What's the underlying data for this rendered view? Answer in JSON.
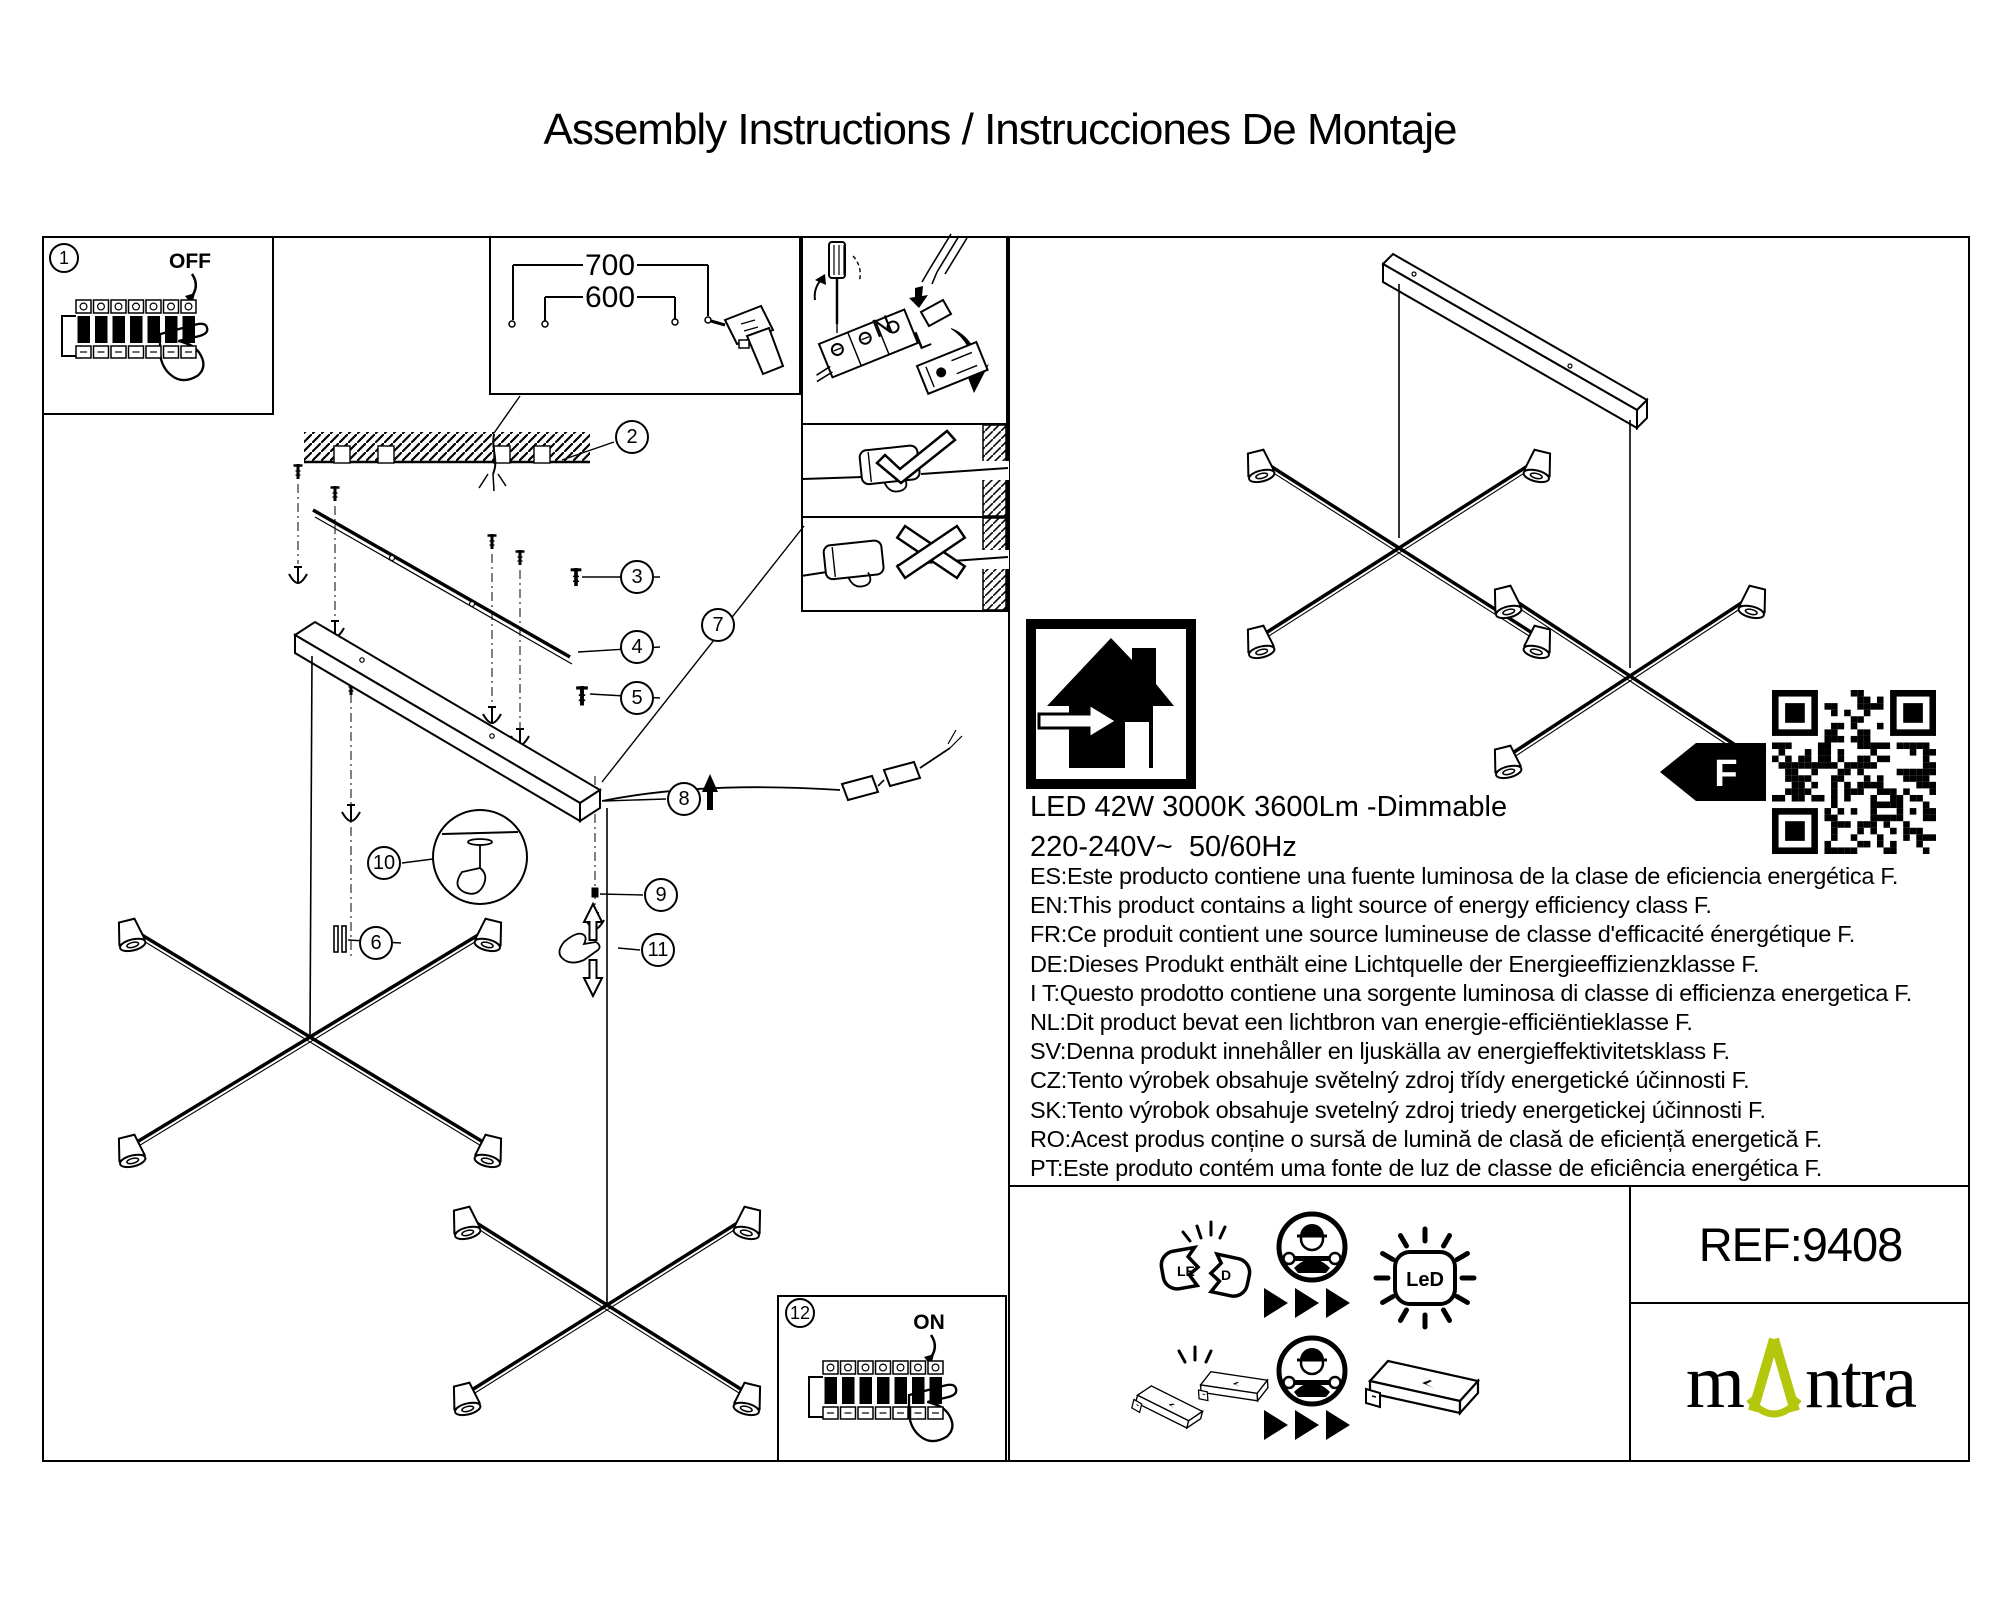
{
  "title": "Assembly Instructions / Instrucciones De Montaje",
  "callouts": [
    "1",
    "2",
    "3",
    "4",
    "5",
    "6",
    "7",
    "8",
    "9",
    "10",
    "11",
    "12"
  ],
  "labels": {
    "off": "OFF",
    "on": "ON",
    "dim_outer": "700",
    "dim_inner": "600",
    "terminal_n": "N",
    "terminal_l": "L",
    "energy_class": "F",
    "led_text": "LeD",
    "led_broken_left": "LE",
    "led_broken_right": "D"
  },
  "specs": {
    "line1": "LED 42W 3000K 3600Lm -Dimmable",
    "line2": "220-240V~  50/60Hz"
  },
  "languages": [
    "ES:Este producto contiene una fuente luminosa de la clase de eficiencia energética F.",
    "EN:This product contains a light source of energy efficiency class F.",
    "FR:Ce produit contient une source lumineuse de classe d'efficacité énergétique F.",
    "DE:Dieses Produkt enthält eine Lichtquelle der Energieeffizienzklasse F.",
    "I T:Questo prodotto contiene una sorgente luminosa di classe di efficienza energetica F.",
    "NL:Dit product bevat een lichtbron van energie-efficiëntieklasse F.",
    "SV:Denna produkt innehåller en ljuskälla av energieffektivitetsklass F.",
    "CZ:Tento výrobek obsahuje světelný zdroj třídy energetické účinnosti F.",
    "SK:Tento výrobok obsahuje svetelný zdroj triedy energetickej účinnosti F.",
    "RO:Acest produs conține o sursă de lumină de clasă de eficiență energetică F.",
    "PT:Este produto contém uma fonte de luz de classe de eficiência energética F."
  ],
  "footer": {
    "ref": "REF:9408",
    "brand_prefix": "m",
    "brand_suffix": "ntra"
  },
  "colors": {
    "brand_green": "#b4c70c",
    "line": "#000000"
  }
}
